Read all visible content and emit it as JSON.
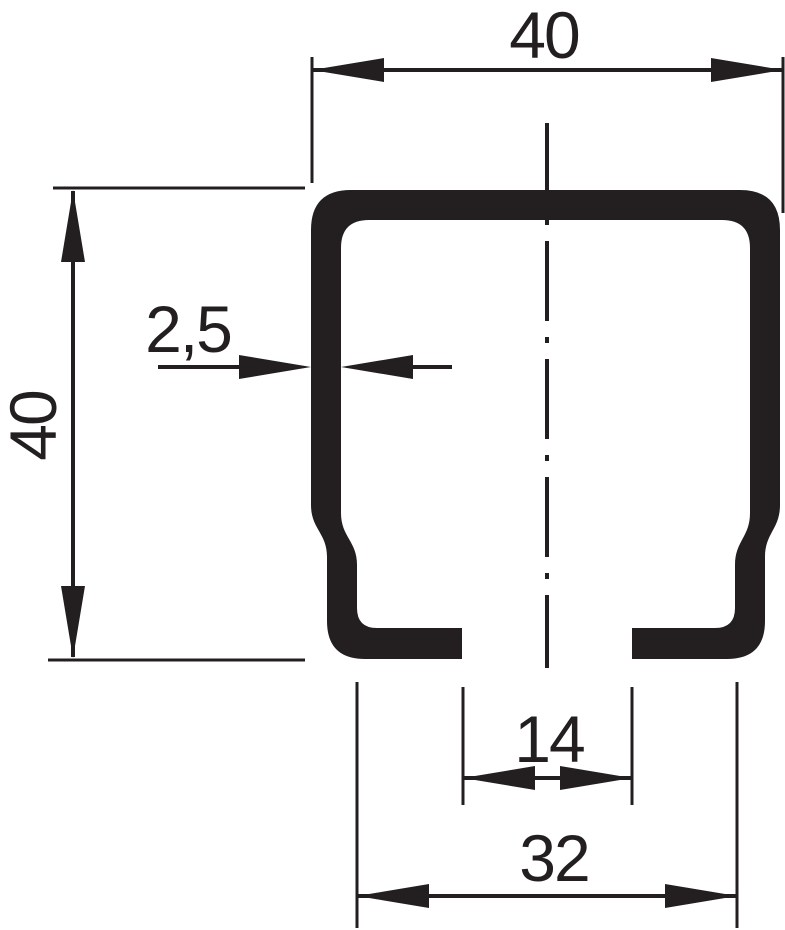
{
  "drawing": {
    "description": "C-channel rail profile cross-section",
    "colors": {
      "ink": "#231f20",
      "background": "#ffffff"
    }
  },
  "dimensions": {
    "top_width": "40",
    "left_height": "40",
    "wall_thickness": "2,5",
    "slot_opening": "14",
    "bottom_width": "32"
  }
}
